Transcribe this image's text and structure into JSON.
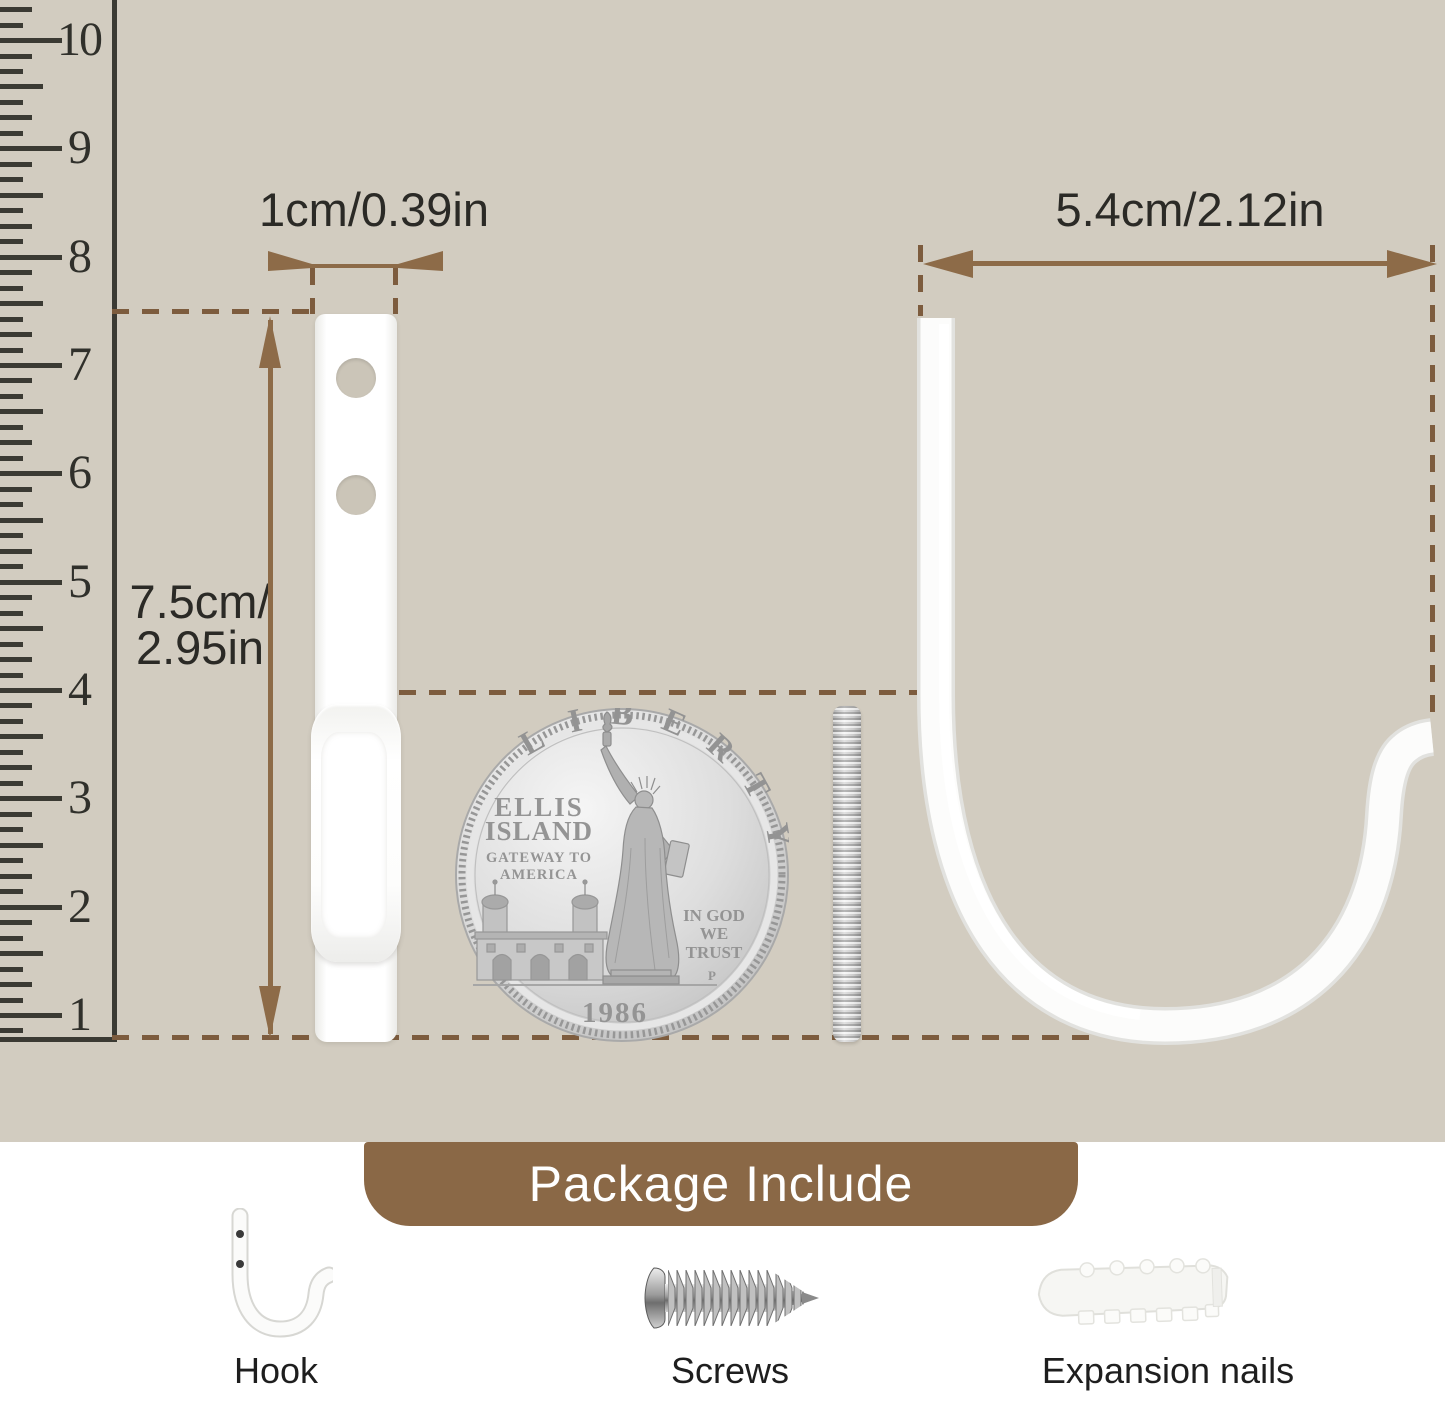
{
  "dimensions": {
    "width_label": "1cm/0.39in",
    "depth_label": "5.4cm/2.12in",
    "height_label_line1": "7.5cm/",
    "height_label_line2": "2.95in"
  },
  "ruler": {
    "numbers": [
      "1",
      "2",
      "3",
      "4",
      "5",
      "6",
      "7",
      "8",
      "9",
      "10"
    ]
  },
  "coin": {
    "arc_text": "LIBERTY",
    "left_line1": "ELLIS",
    "left_line2": "ISLAND",
    "left_line3": "GATEWAY TO",
    "left_line4": "AMERICA",
    "motto_line1": "IN GOD",
    "motto_line2": "WE",
    "motto_line3": "TRUST",
    "mint_mark": "P",
    "year": "1986"
  },
  "package": {
    "title": "Package Include",
    "items": [
      {
        "label": "Hook"
      },
      {
        "label": "Screws"
      },
      {
        "label": "Expansion nails"
      }
    ]
  },
  "colors": {
    "background": "#d2ccc0",
    "panel_white": "#ffffff",
    "arrow_brown": "#8d6b48",
    "dash_brown": "#7d5c3e",
    "banner_brown": "#8a6846",
    "text_dark": "#2b2a26",
    "ruler_ink": "#3b3a33"
  }
}
